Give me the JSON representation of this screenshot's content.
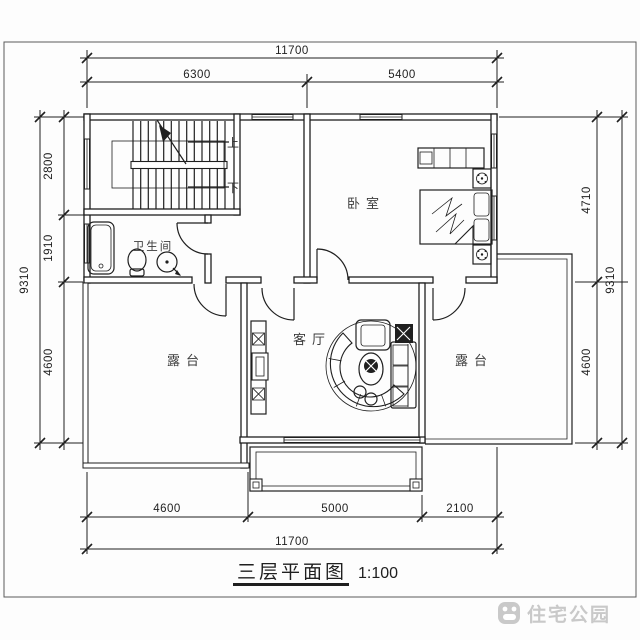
{
  "sheet": {
    "title": "三层平面图",
    "scale_label": "1:100",
    "watermark": "住宅公园"
  },
  "rooms": {
    "bedroom": "卧室",
    "bathroom": "卫生间",
    "living_room": "客厅",
    "terrace_left": "露台",
    "terrace_right": "露台",
    "stair_up": "上",
    "stair_down": "下"
  },
  "dimensions": {
    "top": {
      "total": "11700",
      "segments": [
        "6300",
        "5400"
      ]
    },
    "bottom": {
      "total": "11700",
      "segments": [
        "4600",
        "5000",
        "2100"
      ]
    },
    "left": {
      "total": "9310",
      "segments": [
        "2800",
        "1910",
        "4600"
      ]
    },
    "right": {
      "total": "9310",
      "segments": [
        "4710",
        "4600"
      ]
    }
  },
  "colors": {
    "line": "#1f1f1f",
    "watermark": "#c9c9c9"
  }
}
